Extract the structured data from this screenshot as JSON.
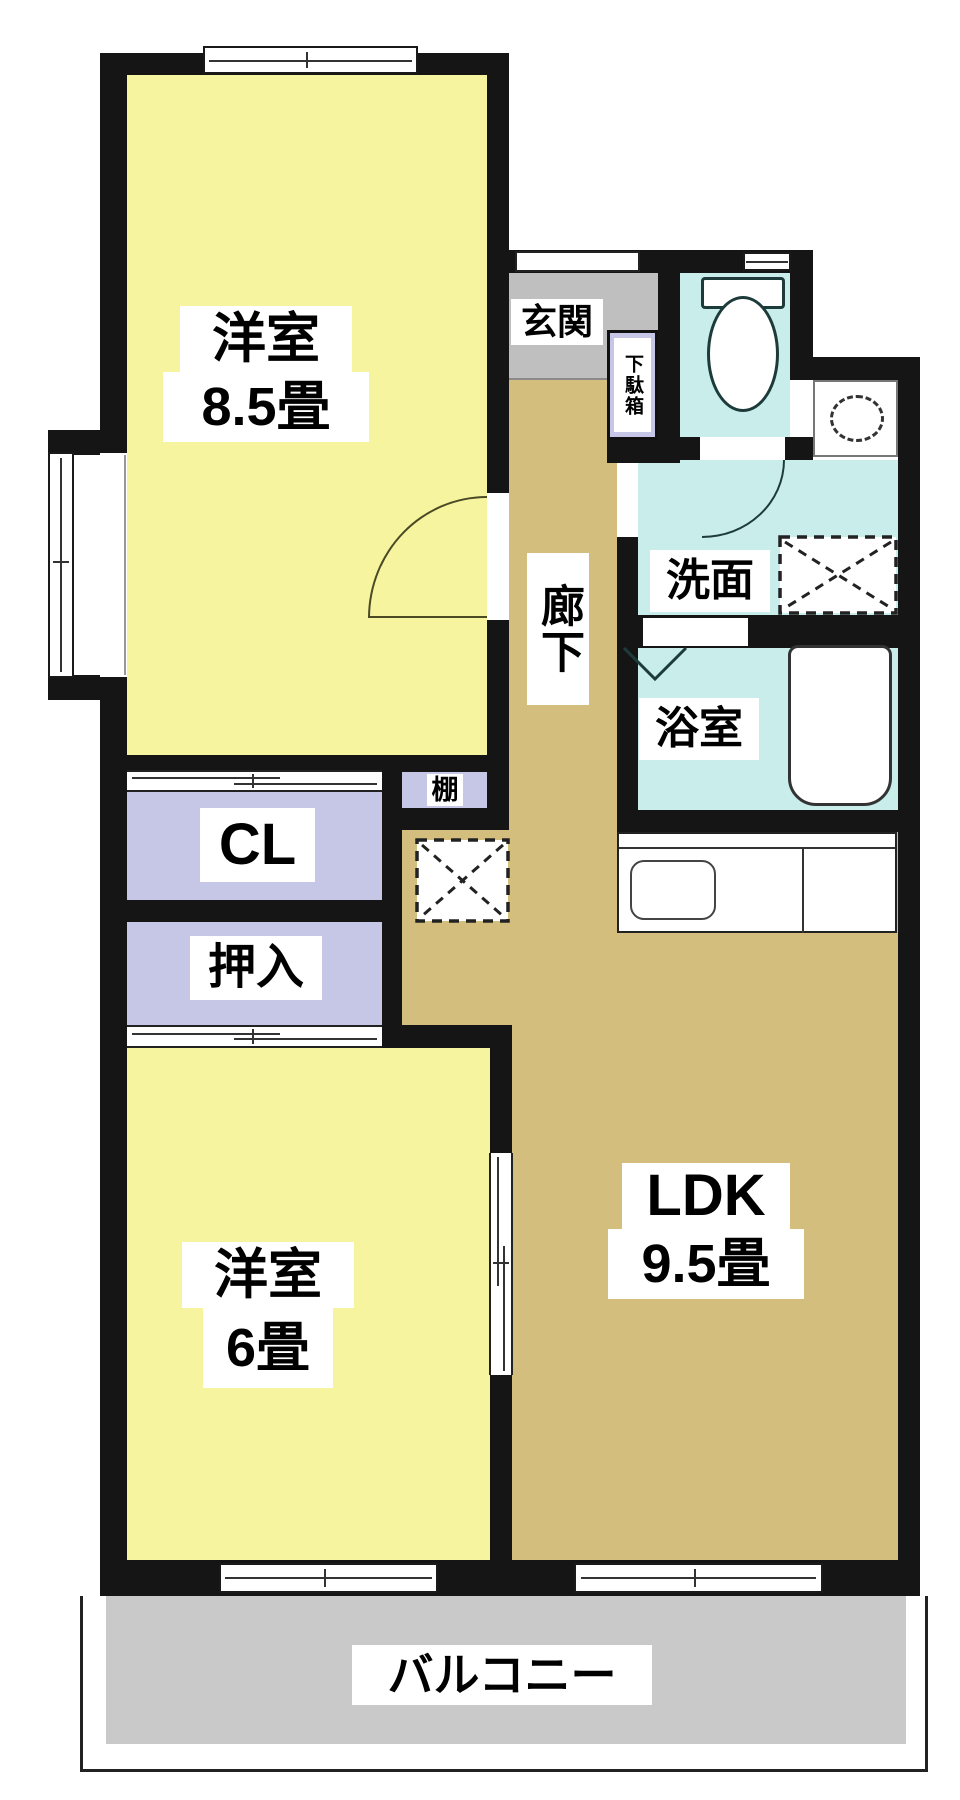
{
  "plan": {
    "title": "2LDK apartment floor plan",
    "rooms": {
      "bedroom_85": {
        "name": "洋室",
        "size": "8.5畳"
      },
      "bedroom_6": {
        "name": "洋室",
        "size": "6畳"
      },
      "ldk": {
        "name": "LDK",
        "size": "9.5畳"
      },
      "entrance": {
        "label": "玄関"
      },
      "shoe_box": {
        "label": "下駄箱"
      },
      "hallway": {
        "label": "廊下"
      },
      "washroom": {
        "label": "洗面"
      },
      "bathroom": {
        "label": "浴室"
      },
      "shelf": {
        "label": "棚"
      },
      "closet": {
        "label": "CL"
      },
      "oshiire": {
        "label": "押入"
      },
      "balcony": {
        "label": "バルコニー"
      }
    },
    "colors": {
      "wall": "#151515",
      "western_room": "#F7F4A0",
      "ldk_floor": "#D4BE7D",
      "wet_area": "#C9EDEB",
      "closet": "#C6C6E6",
      "entrance_floor": "#BFBFBF",
      "balcony_floor": "#C9C9C9"
    }
  }
}
